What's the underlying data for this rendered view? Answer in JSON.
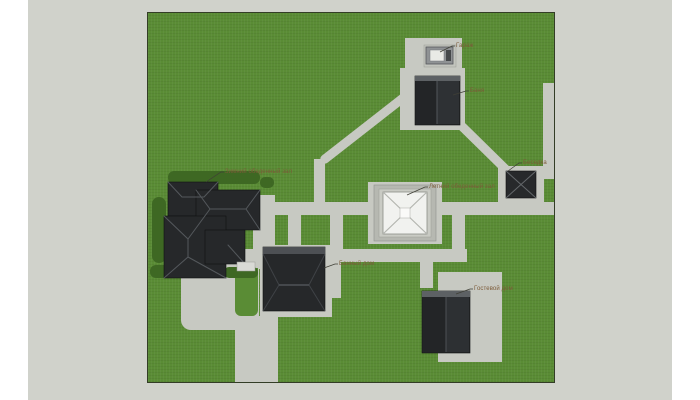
{
  "scene": {
    "labels": {
      "garage": "Гараж",
      "sauna": "Баня",
      "gazebo": "Беседка",
      "summer_dining_hall": "Летний обеденный зал",
      "winter_dining_hall": "Зимний обеденный зал",
      "bath_house": "Банный дом",
      "guest_house": "Гостевой дом"
    },
    "colors": {
      "page": "#ffffff",
      "canvas": "#d0d2cb",
      "lawn": "#5a8c35",
      "lawn_border": "#333d26",
      "path": "#c7c9c2",
      "roof_dark": "#26282a",
      "shrub": "#3e6823",
      "pavilion_white": "#f1f2ef",
      "label_text": "#7c5a38"
    }
  }
}
